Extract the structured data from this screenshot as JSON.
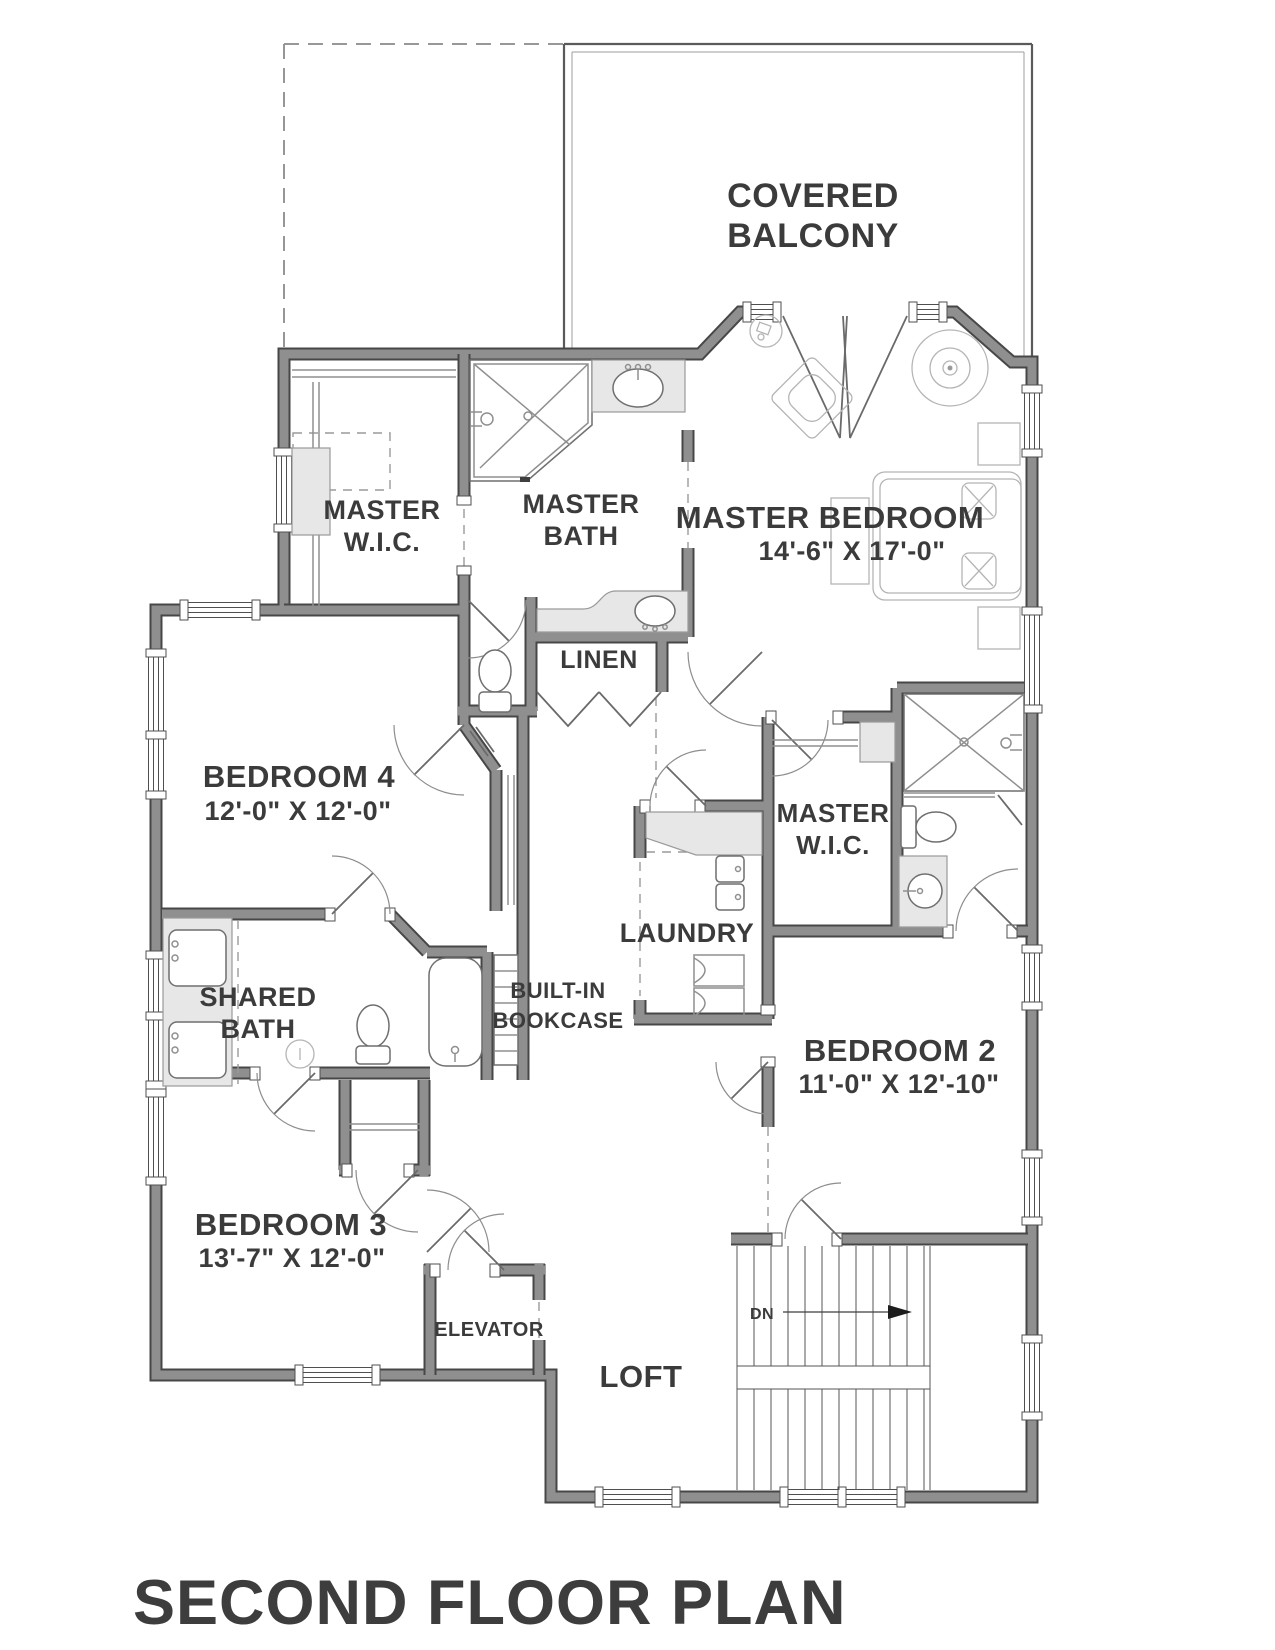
{
  "title": "SECOND FLOOR PLAN",
  "rooms": {
    "covered_balcony": {
      "line1": "COVERED",
      "line2": "BALCONY"
    },
    "master_wic_left": {
      "line1": "MASTER",
      "line2": "W.I.C."
    },
    "master_bath": {
      "line1": "MASTER",
      "line2": "BATH"
    },
    "master_bedroom": {
      "name": "MASTER BEDROOM",
      "dims": "14'-6\" X 17'-0\""
    },
    "linen": {
      "name": "LINEN"
    },
    "bedroom4": {
      "name": "BEDROOM 4",
      "dims": "12'-0\" X 12'-0\""
    },
    "master_wic_right": {
      "line1": "MASTER",
      "line2": "W.I.C."
    },
    "laundry": {
      "name": "LAUNDRY"
    },
    "shared_bath": {
      "line1": "SHARED",
      "line2": "BATH"
    },
    "built_in_bookcase": {
      "line1": "BUILT-IN",
      "line2": "BOOKCASE"
    },
    "bedroom2": {
      "name": "BEDROOM 2",
      "dims": "11'-0\" X 12'-10\""
    },
    "bedroom3": {
      "name": "BEDROOM 3",
      "dims": "13'-7\" X 12'-0\""
    },
    "elevator": {
      "name": "ELEVATOR"
    },
    "loft": {
      "name": "LOFT"
    }
  },
  "stairs": {
    "direction_label": "DN"
  },
  "colors": {
    "wall_core": "#8f8f8f",
    "wall_edge": "#474747",
    "label_text": "#3b3b3b",
    "background": "#ffffff"
  }
}
